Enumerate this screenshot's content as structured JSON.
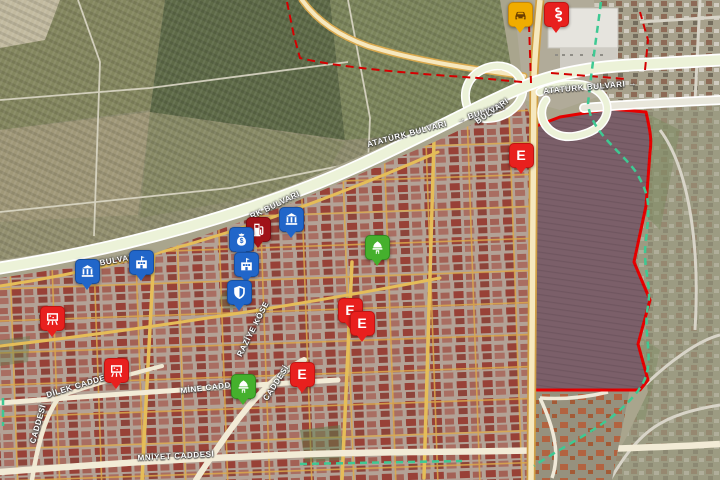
{
  "map": {
    "type": "satellite-map",
    "road_labels": [
      {
        "text": "ATATÜRK BULVARI",
        "x": 407,
        "y": 134,
        "rot": -15
      },
      {
        "text": "→ BULVARI",
        "x": 481,
        "y": 113,
        "rot": -17
      },
      {
        "text": "ATATÜRK BULVARI →",
        "x": 590,
        "y": 87,
        "rot": -5
      },
      {
        "text": "BULVARI",
        "x": 492,
        "y": 111,
        "rot": -35
      },
      {
        "text": "RK BULVARI",
        "x": 275,
        "y": 205,
        "rot": -26
      },
      {
        "text": "RK BULVARI",
        "x": 111,
        "y": 261,
        "rot": -10
      },
      {
        "text": "DİLEK CADDESİ",
        "x": 80,
        "y": 385,
        "rot": -17
      },
      {
        "text": "MİNE CADDESİ",
        "x": 213,
        "y": 387,
        "rot": -7
      },
      {
        "text": "RAZİYE KÖSE",
        "x": 253,
        "y": 329,
        "rot": -63
      },
      {
        "text": "CADDESİ",
        "x": 276,
        "y": 383,
        "rot": -57
      },
      {
        "text": "CADDESİ",
        "x": 38,
        "y": 424,
        "rot": -74
      },
      {
        "text": "MNİYET CADDESİ",
        "x": 176,
        "y": 456,
        "rot": -3
      }
    ],
    "pins": [
      {
        "id": "taxi-stand",
        "color": "amber",
        "icon": "car-icon",
        "x": 520,
        "y": 14
      },
      {
        "id": "health-point",
        "color": "red",
        "icon": "snake-icon",
        "x": 556,
        "y": 14
      },
      {
        "id": "pharmacy-1",
        "color": "red",
        "icon": "letter-e-icon",
        "label": "E",
        "x": 521,
        "y": 155
      },
      {
        "id": "fuel-station",
        "color": "darkred",
        "icon": "fuel-pump-icon",
        "x": 258,
        "y": 229
      },
      {
        "id": "bank-1",
        "color": "blue",
        "icon": "bank-columns-icon",
        "x": 291,
        "y": 219
      },
      {
        "id": "money-exchange",
        "color": "blue",
        "icon": "money-bag-icon",
        "x": 241,
        "y": 239
      },
      {
        "id": "public-building-1",
        "color": "blue",
        "icon": "building-flag-icon",
        "x": 246,
        "y": 264
      },
      {
        "id": "police-shield",
        "color": "blue",
        "icon": "shield-icon",
        "x": 239,
        "y": 292
      },
      {
        "id": "bank-2",
        "color": "blue",
        "icon": "bank-columns-icon",
        "x": 87,
        "y": 271
      },
      {
        "id": "public-building-2",
        "color": "blue",
        "icon": "building-flag-icon",
        "x": 141,
        "y": 262
      },
      {
        "id": "school-1",
        "color": "red",
        "icon": "school-board-icon",
        "x": 52,
        "y": 318
      },
      {
        "id": "school-2",
        "color": "red",
        "icon": "school-board-icon",
        "x": 116,
        "y": 370
      },
      {
        "id": "mosque-1",
        "color": "green",
        "icon": "mosque-dome-icon",
        "x": 377,
        "y": 247
      },
      {
        "id": "mosque-2",
        "color": "green",
        "icon": "mosque-dome-icon",
        "x": 243,
        "y": 386
      },
      {
        "id": "pharmacy-2",
        "color": "red",
        "icon": "letter-e-icon",
        "label": "E",
        "x": 350,
        "y": 310
      },
      {
        "id": "pharmacy-3",
        "color": "red",
        "icon": "letter-e-icon",
        "label": "E",
        "x": 362,
        "y": 323
      },
      {
        "id": "pharmacy-4",
        "color": "red",
        "icon": "letter-e-icon",
        "label": "E",
        "x": 302,
        "y": 374
      }
    ],
    "overlays": {
      "zone_boundary_solid_color": "#e60000",
      "zone_boundary_dashed_color": "#d40000",
      "route_dashed_color": "#3ec993"
    },
    "pin_colors": {
      "pharmacy": "#e8201e",
      "fuel": "#a01218",
      "public": "#2166c9",
      "mosque": "#45b02d",
      "taxi": "#f0ac00"
    }
  }
}
